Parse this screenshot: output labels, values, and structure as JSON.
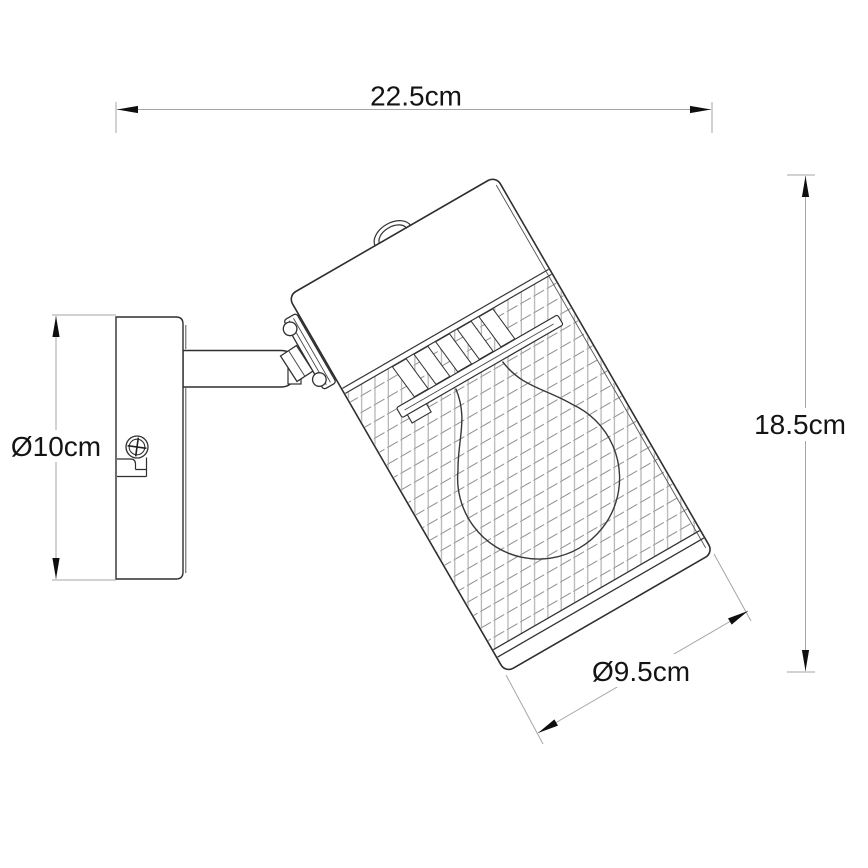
{
  "page": {
    "background": "#ffffff"
  },
  "diagram": {
    "type": "product dimension drawing",
    "subject": "wall-mounted swivel spotlight with mesh shade and bulb",
    "dimensions": {
      "overall_width": "22.5cm",
      "overall_height": "18.5cm",
      "wall_plate_diameter": "Ø10cm",
      "shade_diameter": "Ø9.5cm"
    },
    "colors": {
      "outline": "#2f2f2f",
      "dimension_line": "#a6a6a6",
      "arrow": "#0f0f0f",
      "label_text": "#141414",
      "mesh_line_vertical": "#ababab",
      "mesh_line_diagonal": "#8e8e8e",
      "background": "#ffffff"
    }
  }
}
